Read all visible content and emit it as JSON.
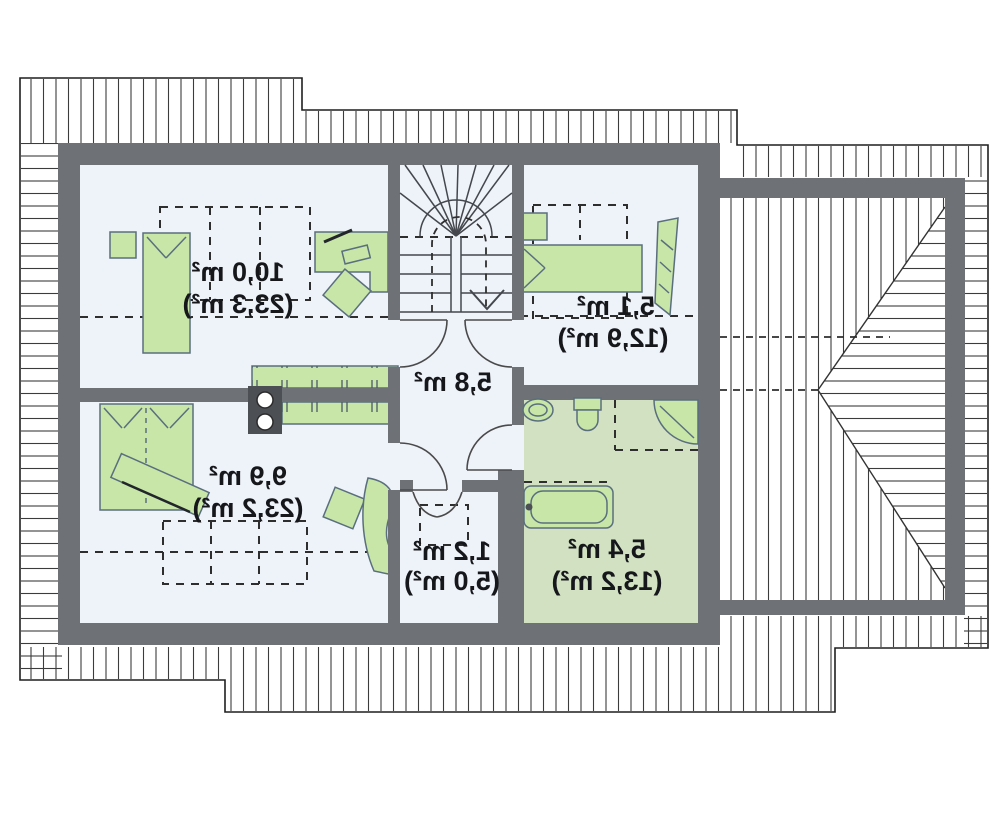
{
  "plan": {
    "title": "attic-floor-plan-mirrored",
    "rooms": [
      {
        "name": "bedroom-1",
        "area": "10,0 m²",
        "floor_area": "(23,3 m²)"
      },
      {
        "name": "bedroom-2",
        "area": "5,1 m²",
        "floor_area": "(12,9 m²)"
      },
      {
        "name": "hall",
        "area": "5,8 m²",
        "floor_area": ""
      },
      {
        "name": "bedroom-3",
        "area": "9,9 m²",
        "floor_area": "(23,2 m²)"
      },
      {
        "name": "closet",
        "area": "1,2 m²",
        "floor_area": "(5,0 m²)"
      },
      {
        "name": "bathroom",
        "area": "5,4 m²",
        "floor_area": "(13,2 m²)"
      }
    ],
    "colors": {
      "wall": "#6e7176",
      "floor": "#eef2f9",
      "bathroom_floor": "#d2e1c2",
      "furniture_fill": "#c7e6a8",
      "furniture_stroke": "#5a6e7e",
      "hatch_line": "#3c3c3c",
      "outline": "#1f1f1f",
      "label_text": "#15171b"
    }
  }
}
